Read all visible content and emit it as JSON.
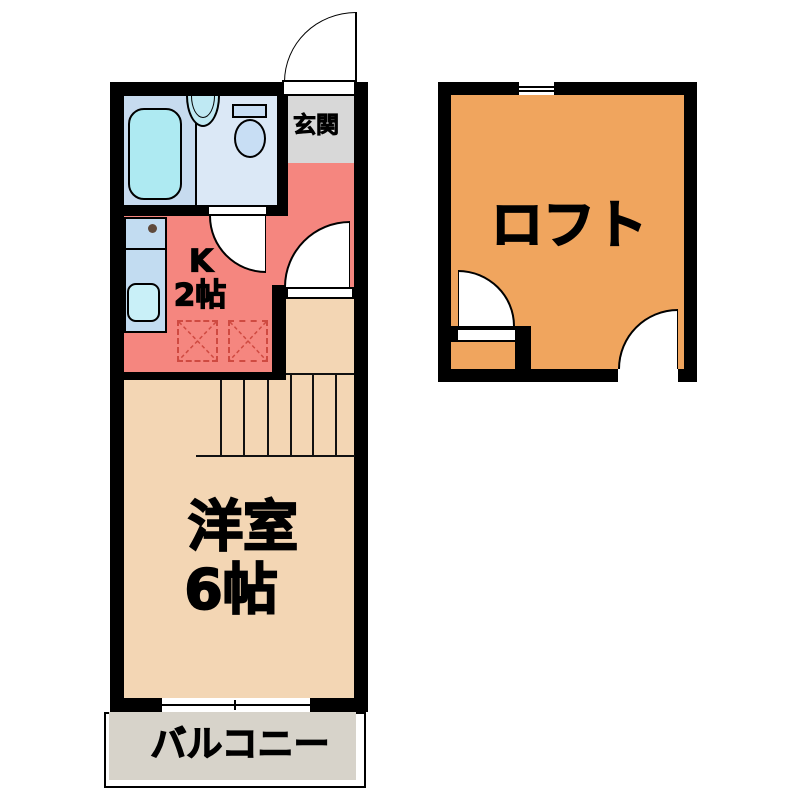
{
  "page": {
    "background": "#ffffff",
    "description": "1K apartment floor plan with loft"
  },
  "colors": {
    "wall": "#000000",
    "bathroom_floor": "#c7dbef",
    "toilet_floor": "#dbe8f6",
    "genkan_floor": "#d8d8d8",
    "kitchen_floor": "#f5867f",
    "room_floor": "#f3d6b4",
    "loft_floor": "#f0a55e",
    "balcony_floor": "#d7d3ca",
    "bathtub": "#aeeaf2",
    "washbasin": "#bfe9f3",
    "toilet_fixture": "#c8def4",
    "kitchen_counter": "#c2dcf1",
    "kitchen_sink": "#c9f0f8",
    "appliance_dashed": "#cf4a41"
  },
  "labels": {
    "genkan": "玄関",
    "kitchen_type": "K",
    "kitchen_size": "2帖",
    "main_room_name": "洋室",
    "main_room_size": "6帖",
    "loft": "ロフト",
    "balcony": "バルコニー"
  }
}
